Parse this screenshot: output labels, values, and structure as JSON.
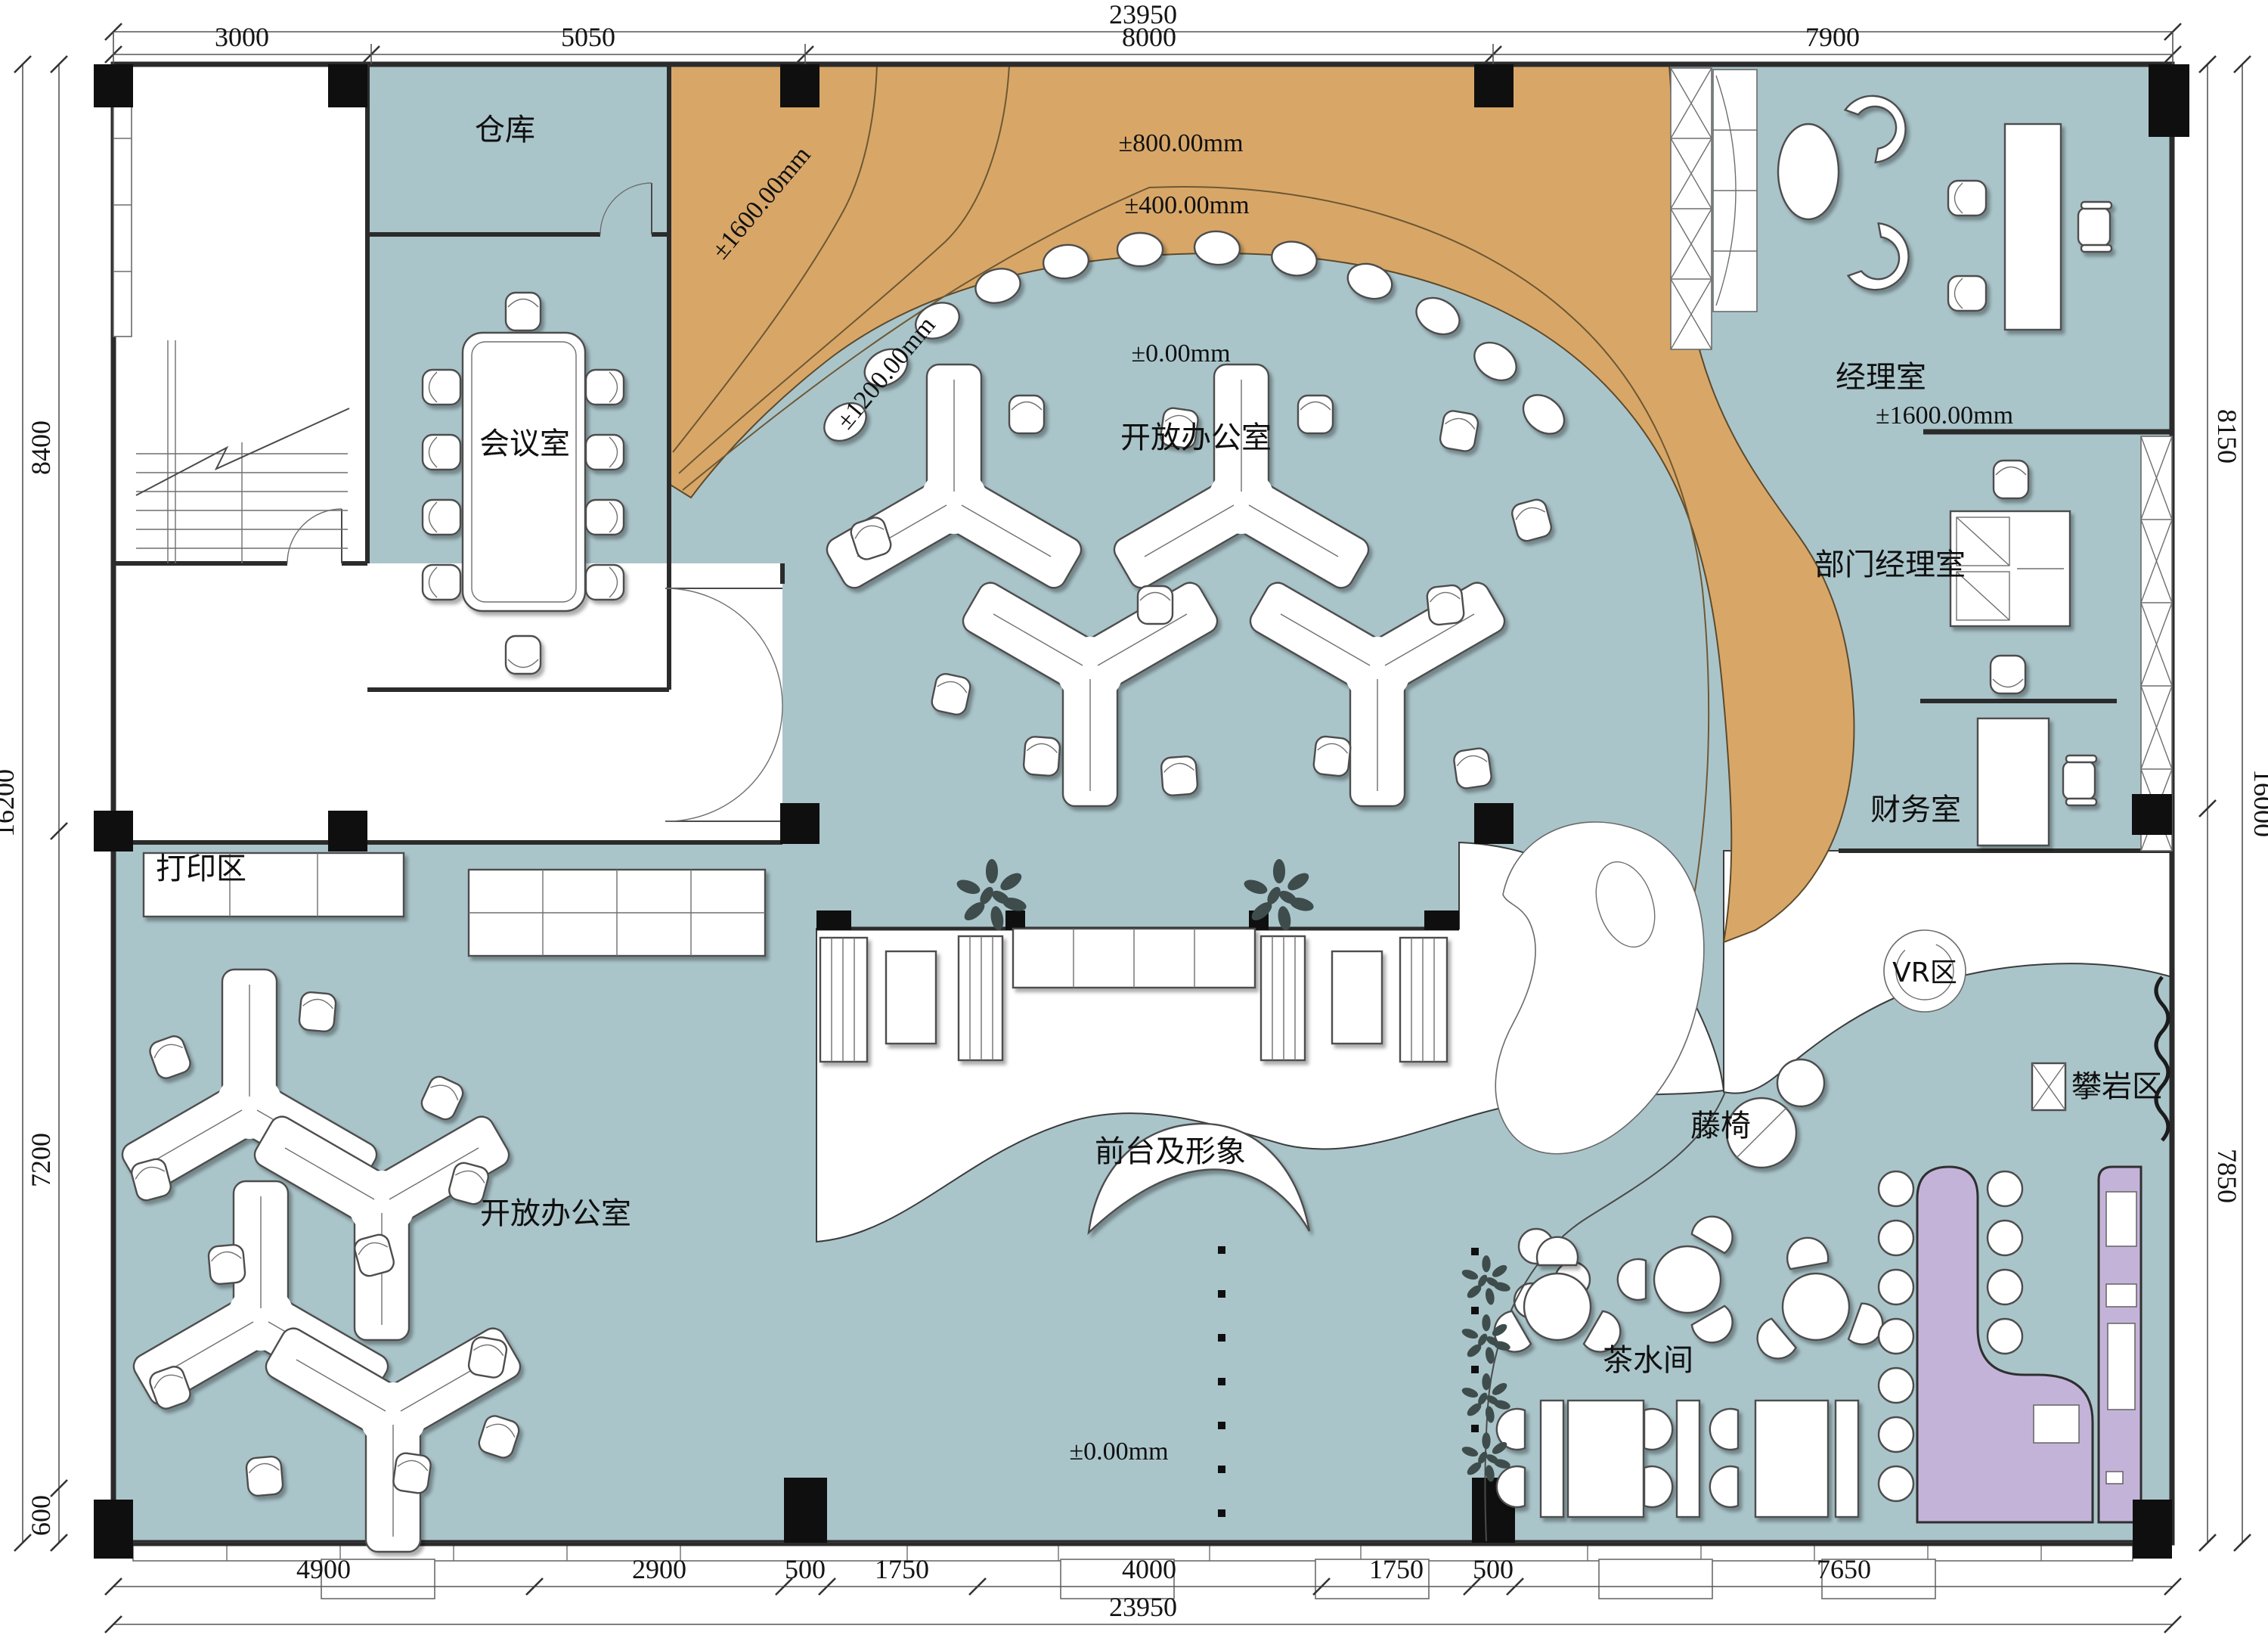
{
  "plan": {
    "title": "office-floor-plan",
    "rooms": {
      "warehouse": "仓库",
      "meeting_room": "会议室",
      "open_office_top": "开放办公室",
      "open_office_left": "开放办公室",
      "manager_office": "经理室",
      "dept_manager_office": "部门经理室",
      "finance_office": "财务室",
      "print_area": "打印区",
      "vr_area": "VR区",
      "climbing_area": "攀岩区",
      "rattan_chair": "藤椅",
      "tea_room": "茶水间",
      "reception": "前台及形象"
    },
    "elevations": {
      "ramp_1600": "±1600.00mm",
      "ramp_1200": "±1200.00mm",
      "ramp_800": "±800.00mm",
      "ramp_400": "±400.00mm",
      "floor_zero_top": "±0.00mm",
      "floor_zero_bottom": "±0.00mm",
      "manager_1600": "±1600.00mm"
    },
    "dimensions": {
      "top_total": "23950",
      "top_segments": [
        "3000",
        "5050",
        "8000",
        "7900"
      ],
      "bottom_total": "23950",
      "bottom_segments": [
        "4900",
        "2900",
        "500",
        "1750",
        "4000",
        "1750",
        "500",
        "7650"
      ],
      "left_total": "16200",
      "left_segments": [
        "8400",
        "7200",
        "600"
      ],
      "right_total": "16000",
      "right_segments": [
        "8150",
        "7850"
      ]
    },
    "colors": {
      "floor": "#aac5ca",
      "ramp": "#d8a768",
      "accent": "#c4b3d9",
      "wall": "#2b2b2b"
    }
  }
}
